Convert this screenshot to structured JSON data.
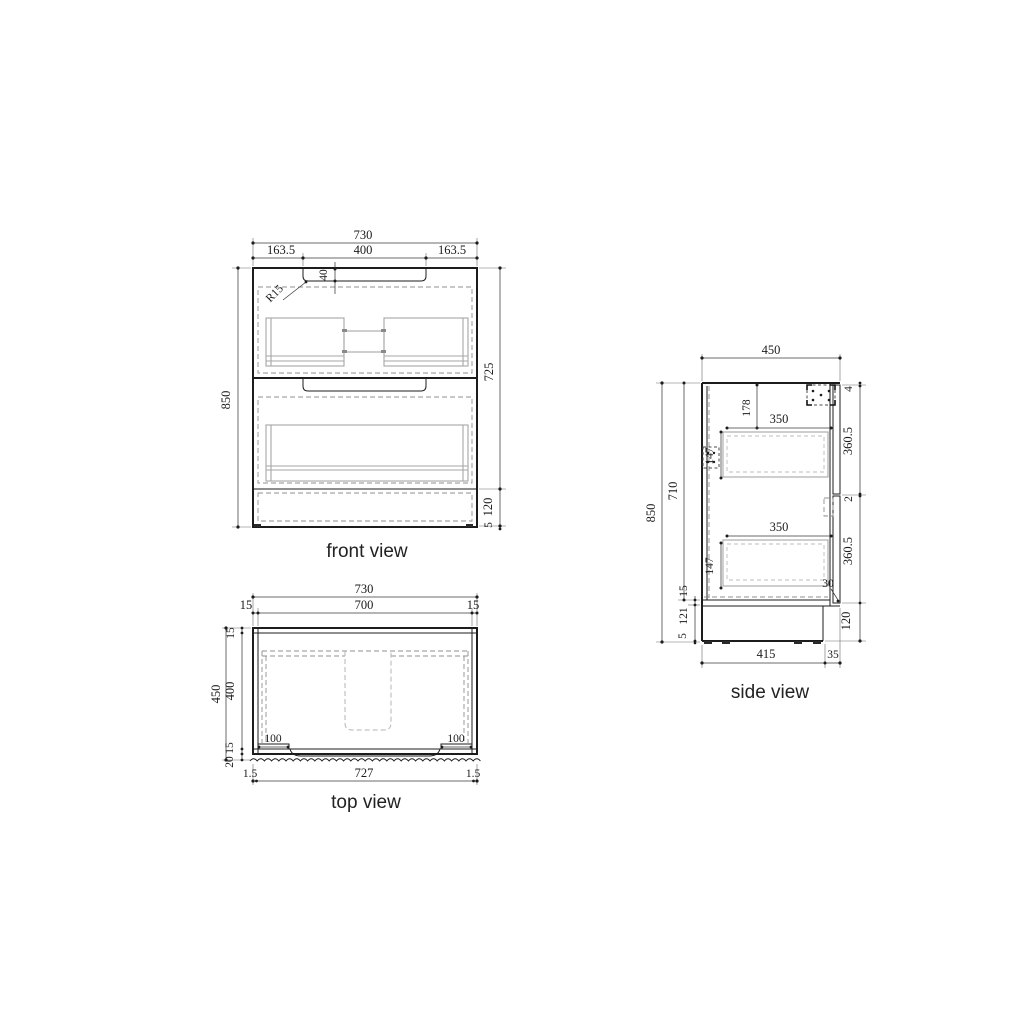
{
  "page": {
    "background": "#ffffff",
    "line_color": "#1c1c1c",
    "interior_line_color": "#a6a6a6"
  },
  "front_view": {
    "label": "front view",
    "dims": {
      "w_total": "730",
      "w_left": "163.5",
      "w_mid": "400",
      "w_right": "163.5",
      "recess_depth": "40",
      "radius": "R15",
      "h_total": "850",
      "h_body": "725",
      "h_kick": "120",
      "h_foot": "5"
    }
  },
  "top_view": {
    "label": "top view",
    "dims": {
      "w_total": "730",
      "w_inner": "700",
      "wall_left": "15",
      "wall_right": "15",
      "d_total": "450",
      "back_panel": "15",
      "d_inner": "400",
      "front_rail": "15",
      "front_edge": "20",
      "inset_left": "100",
      "inset_right": "100",
      "edge_left": "1.5",
      "w_front": "727",
      "edge_right": "1.5"
    }
  },
  "side_view": {
    "label": "side view",
    "dims": {
      "d_total": "450",
      "h_total": "850",
      "h_carcass": "710",
      "bottom_panel": "15",
      "leg_space": "121",
      "foot": "5",
      "gap_top": "4",
      "front_upper": "360.5",
      "gap_mid": "2",
      "front_lower": "360.5",
      "kick": "120",
      "top_offset": "178",
      "depth_upper": "350",
      "box_upper": "147",
      "depth_lower": "350",
      "box_lower": "147",
      "step": "30",
      "base_depth": "415",
      "overhang": "35"
    }
  }
}
